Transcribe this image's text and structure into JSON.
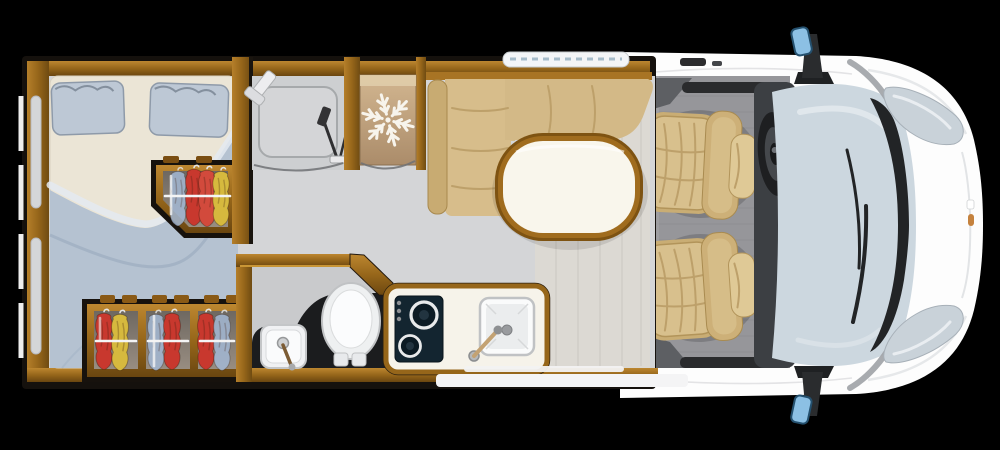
{
  "scene": {
    "type": "motorhome floor plan, top-down view",
    "background": "#000000"
  },
  "palette": {
    "outline": "#15110d",
    "wood": "#a06c1e",
    "wood_dark": "#6e4a12",
    "floor": "#d4d5d7",
    "plank_floor": "#dcd9d3",
    "mattress": "#ebe5d6",
    "bedding_blue": "#b5c2d1",
    "pillow": "#bdc8d5",
    "upholstery_tan": "#d7bd8b",
    "table_top": "#f9f6ec",
    "table_rim": "#8a5c16",
    "cab_floor": "#96969a",
    "vehicle_body": "#fdfdfd",
    "windscreen_glass": "#ccd7df",
    "mirror_glass": "#8cc0e4",
    "dark_fixture": "#1b1c1e",
    "hob_panel": "#132530",
    "fridge_interior": "#c4a77e",
    "garment_red": "#c8382e",
    "garment_yellow": "#d6b93e",
    "garment_blue": "#a3b8d4",
    "headlight": "#c9d2d9",
    "accent_gold": "#d9a33c"
  },
  "rooms": {
    "bedroom": {
      "name": "rear bedroom",
      "bed": {
        "pillow_count": 2
      },
      "rear_wall_windows": 2
    },
    "wardrobe_mid": {
      "name": "wardrobe",
      "rail_color": "white",
      "garments": [
        "blue",
        "red",
        "red",
        "yellow"
      ]
    },
    "wardrobe_rear": {
      "name": "triple wardrobe",
      "sections": [
        {
          "garments": [
            "red",
            "yellow"
          ]
        },
        {
          "garments": [
            "blue",
            "red"
          ]
        },
        {
          "garments": [
            "red",
            "blue"
          ]
        }
      ]
    },
    "shower": {
      "name": "shower room",
      "icons": [
        "shower-head-icon",
        "shower-mixer-icon",
        "door-swing-arc"
      ]
    },
    "fridge": {
      "name": "refrigerator",
      "icons": [
        "snowflake-icon",
        "door-swing-arc"
      ]
    },
    "dinette": {
      "name": "L-shaped dinette",
      "features": [
        "bench-back-cushion",
        "oval-table",
        "window-strip"
      ]
    },
    "washroom": {
      "name": "washroom",
      "fixtures": [
        "toilet",
        "washbasin",
        "tap"
      ]
    },
    "kitchen": {
      "name": "kitchen block",
      "fixtures": [
        "two-burner-hob",
        "sink",
        "tap"
      ],
      "burners": 2,
      "knobs": 3
    },
    "entry": {
      "name": "entry step strip"
    }
  },
  "cab": {
    "name": "driver cab",
    "seats": [
      {
        "role": "driver",
        "facing": "rear"
      },
      {
        "role": "passenger",
        "facing": "rear"
      }
    ],
    "fixtures": [
      "steering-wheel",
      "dashboard",
      "windscreen",
      "wipers",
      "wing-mirror-top",
      "wing-mirror-bottom",
      "headlight-top",
      "headlight-bottom",
      "amber-side-marker"
    ]
  }
}
